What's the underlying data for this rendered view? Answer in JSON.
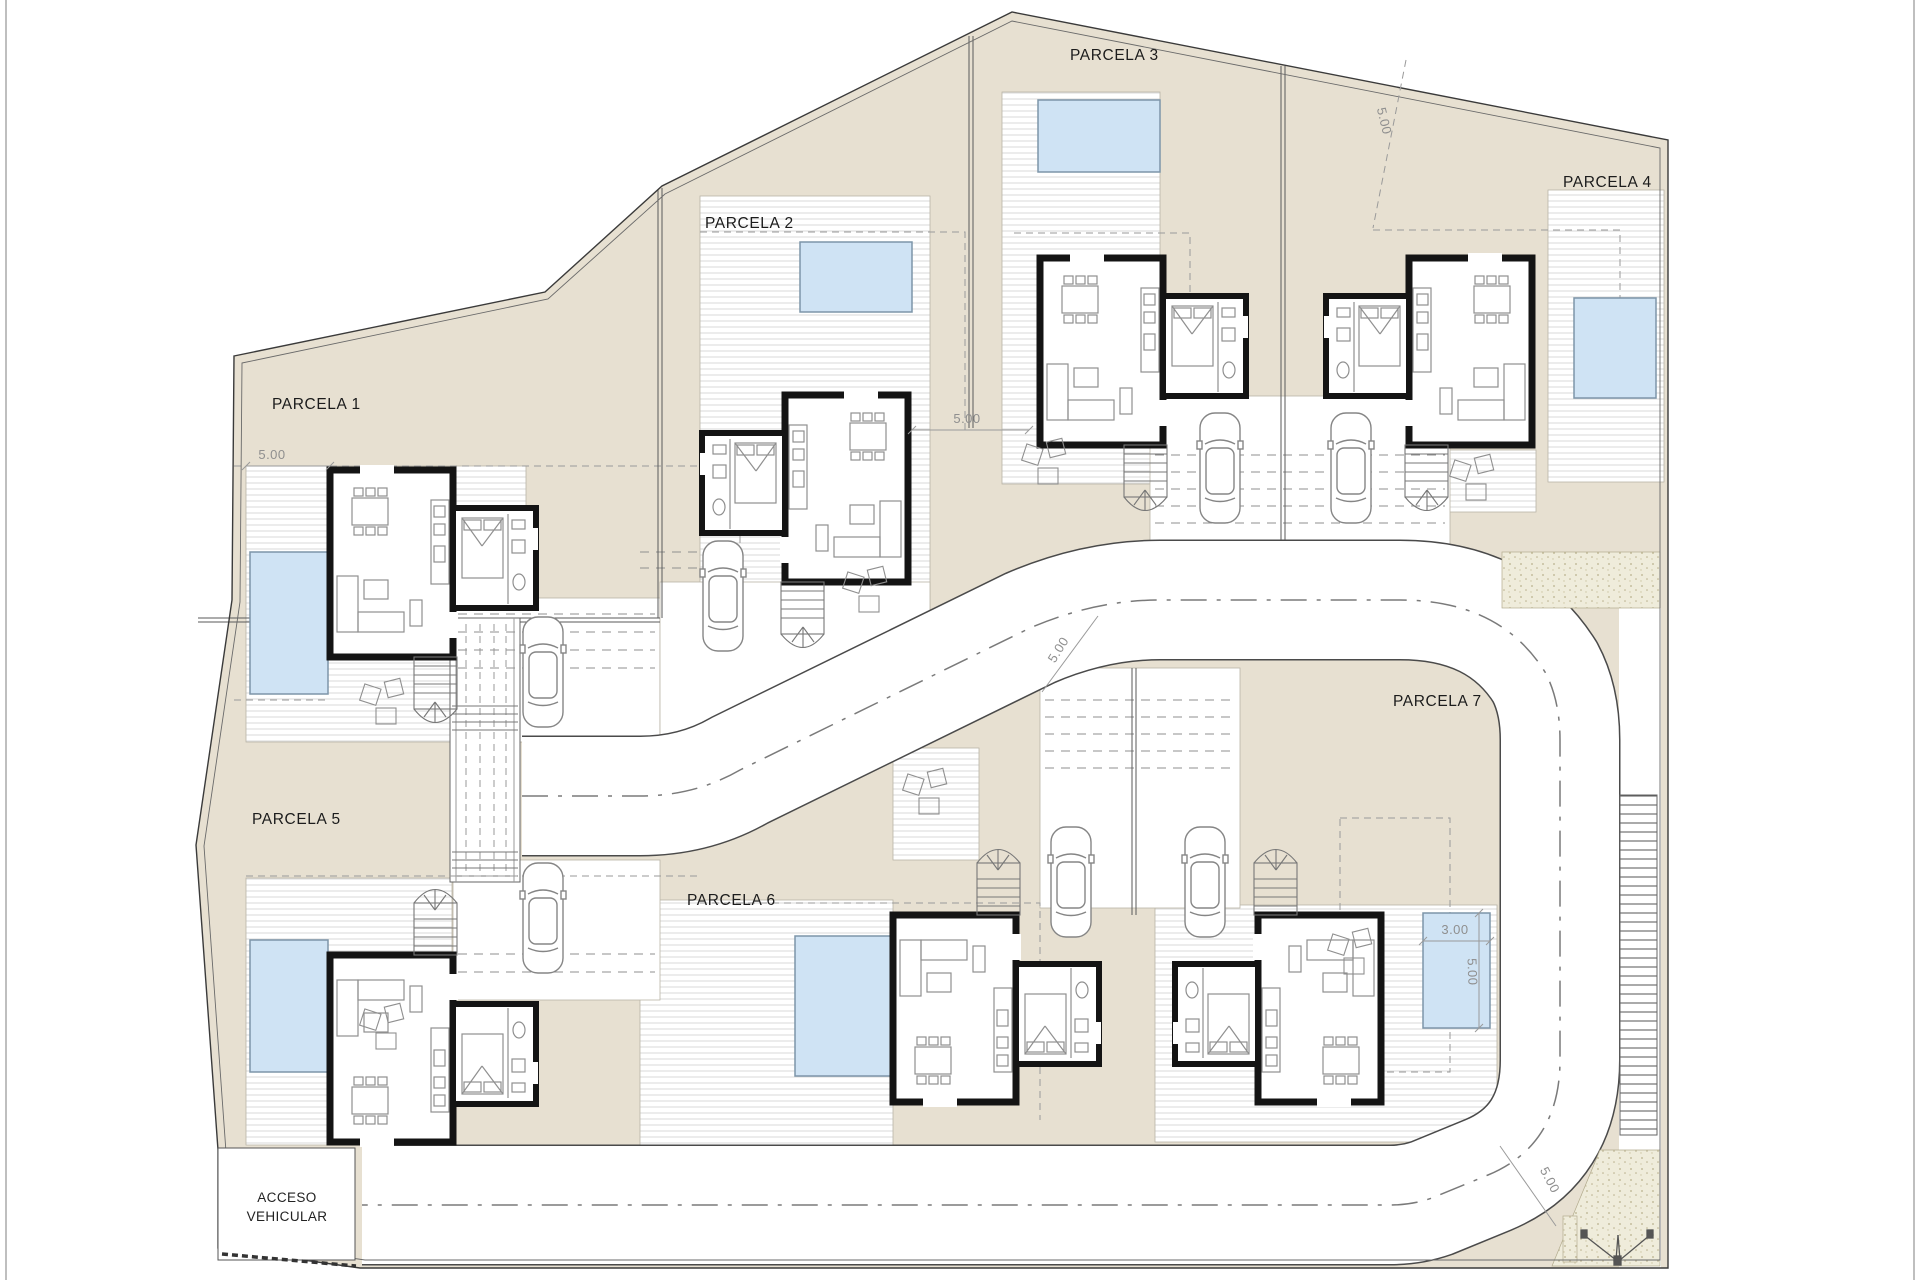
{
  "plan_title": "site-plan-urbanization",
  "parcels": [
    {
      "label": "PARCELA 1"
    },
    {
      "label": "PARCELA 2"
    },
    {
      "label": "PARCELA 3"
    },
    {
      "label": "PARCELA 4"
    },
    {
      "label": "PARCELA 5"
    },
    {
      "label": "PARCELA 6"
    },
    {
      "label": "PARCELA 7"
    }
  ],
  "access": {
    "line1": "ACCESO",
    "line2": "VEHICULAR"
  },
  "dims": {
    "setback_p1": "5.00",
    "setback_p3": "5.00",
    "setback_p4": "5.00",
    "road_width_mid": "5.00",
    "road_width_corner": "5.00",
    "pool_width": "3.00",
    "pool_length": "5.00"
  },
  "colors": {
    "parcel_fill": "#e7e0d1",
    "pool_fill": "#cfe3f4",
    "pool_border": "#7d95a9",
    "wall": "#141414",
    "sand_fill": "#efecdb",
    "furniture_line": "#8f8f8f",
    "boundary_line": "#3a3a3a",
    "road_edge": "#4a4a4a"
  }
}
